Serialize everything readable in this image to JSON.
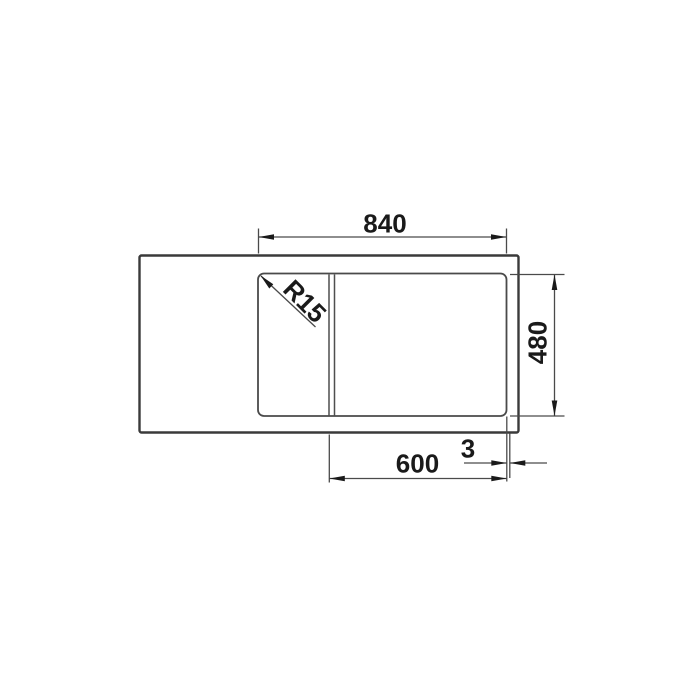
{
  "diagram": {
    "type": "technical dimension drawing",
    "subject": "kitchen sink top view with drainboard, divider strip and main bowl",
    "view": "top",
    "labels": {
      "overall_width": "840",
      "overall_depth": "480",
      "bowl_width": "600",
      "edge_offset": "3",
      "corner_radius": "R15"
    },
    "colors": {
      "background": "#ffffff",
      "outline": "#3a3a3a",
      "dimension_lines": "#4a4a4a",
      "text": "#1a1a1a"
    }
  }
}
